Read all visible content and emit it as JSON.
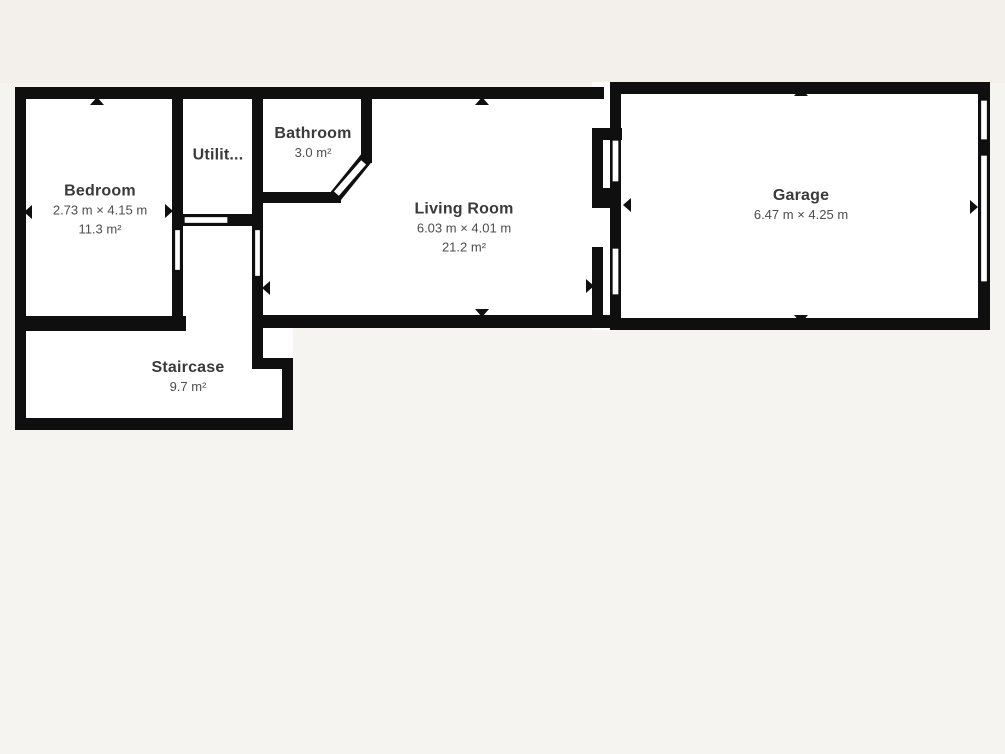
{
  "canvas": {
    "background": "#f3f0ec",
    "drawing_area_background": "#f6f4f1"
  },
  "colors": {
    "wall": "#0f0f0f",
    "room_fill": "#ffffff",
    "room_name_text": "#3a3a3a",
    "room_dim_text": "#4d4d4d"
  },
  "rooms": [
    {
      "id": "bedroom",
      "name": "Bedroom",
      "dimensions": "2.73 m × 4.15 m",
      "area": "11.3 m²"
    },
    {
      "id": "utility",
      "name": "Utilit..."
    },
    {
      "id": "bathroom",
      "name": "Bathroom",
      "area": "3.0 m²"
    },
    {
      "id": "living-room",
      "name": "Living Room",
      "dimensions": "6.03 m × 4.01 m",
      "area": "21.2 m²"
    },
    {
      "id": "garage",
      "name": "Garage",
      "dimensions": "6.47 m × 4.25 m"
    },
    {
      "id": "staircase",
      "name": "Staircase",
      "area": "9.7 m²"
    }
  ]
}
